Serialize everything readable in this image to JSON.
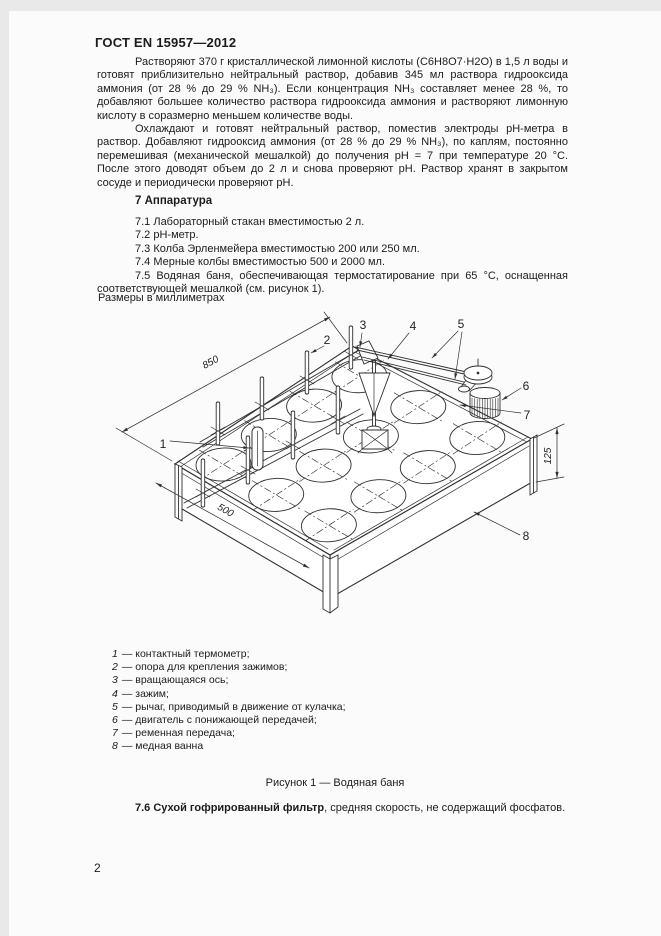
{
  "page": {
    "header": "ГОСТ EN 15957—2012",
    "page_number": "2"
  },
  "content": {
    "paragraph_1": "Растворяют 370 г кристаллической лимонной кислоты (C6H8O7·H2O) в 1,5 л воды и готовят приблизительно нейтральный раствор, добавив 345 мл раствора гидрооксида аммония (от 28 % до 29 % NH₃). Если концентрация NH₃ составляет менее 28 %, то добавляют большее количество раствора гидрооксида аммония и растворяют лимонную кислоту в соразмерно меньшем количестве воды.",
    "paragraph_2": "Охлаждают и готовят нейтральный раствор, поместив электроды pH-метра в раствор. Добавляют гидрооксид аммония (от 28 % до 29 % NH₃), по каплям, постоянно перемешивая (механической мешалкой) до получения pH = 7 при температуре 20 °C. После этого доводят объем до 2 л и снова проверяют pH. Раствор хранят в закрытом сосуде и периодически проверяют pH.",
    "section_heading": "7 Аппаратура",
    "apparatus_items": [
      "7.1 Лабораторный стакан вместимостью 2 л.",
      "7.2 pH-метр.",
      "7.3 Колба Эрленмейера вместимостью 200 или 250 мл.",
      "7.4 Мерные колбы вместимостью 500 и 2000 мл.",
      "7.5 Водяная баня, обеспечивающая термостатирование при 65 °C, оснащенная соответствующей мешалкой (см. рисунок 1)."
    ],
    "dimensions_note": "Размеры в миллиметрах",
    "figure_caption": "Рисунок 1 — Водяная баня",
    "item_7_6": {
      "lead": "7.6 Сухой гофрированный фильтр",
      "rest": ", средняя скорость, не содержащий фосфатов."
    }
  },
  "figure": {
    "dimensions": {
      "length": "850",
      "width": "500",
      "height": "125"
    },
    "callouts": [
      "1",
      "2",
      "3",
      "4",
      "5",
      "6",
      "7",
      "8"
    ],
    "legend": [
      {
        "num": "1",
        "text": "— контактный термометр;"
      },
      {
        "num": "2",
        "text": "— опора для крепления зажимов;"
      },
      {
        "num": "3",
        "text": "— вращающаяся ось;"
      },
      {
        "num": "4",
        "text": "— зажим;"
      },
      {
        "num": "5",
        "text": "— рычаг, приводимый в движение от кулачка;"
      },
      {
        "num": "6",
        "text": "— двигатель с понижающей передачей;"
      },
      {
        "num": "7",
        "text": "— ременная передача;"
      },
      {
        "num": "8",
        "text": "— медная ванна"
      }
    ]
  }
}
